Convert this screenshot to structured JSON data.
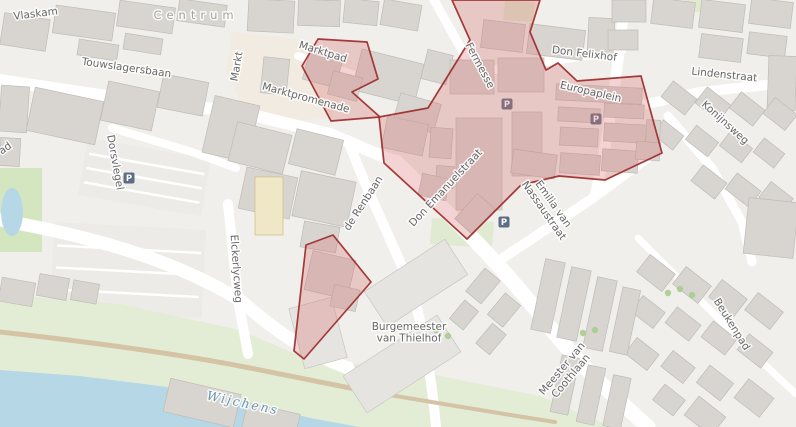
{
  "map": {
    "background": "#f0efeb",
    "palette": {
      "building_fill": "#d8d5d1",
      "building_stroke": "#bfbcb7",
      "building_light_fill": "#e6e4e0",
      "building_light_stroke": "#c9c6c1",
      "building_yellow_fill": "#f0e7c6",
      "building_yellow_stroke": "#cdbd85",
      "plaza": "#f2ebe1",
      "parking_lot": "#ecebe7",
      "green": "#dfead0",
      "green_band": "#e3edd6",
      "park": "#d4e6c0",
      "water": "#b6d7e6",
      "tan_path": "#d4c3a5",
      "road": "#ffffff",
      "overlay_fill": "#d97272",
      "overlay_fill_opacity": 0.31,
      "overlay_stroke": "#a03030",
      "overlay_stroke_width": 1.7,
      "label_color": "#676767",
      "place_label_color": "#a2a2a2",
      "water_label_color": "#6b95ab",
      "parking_icon_bg": "#5d6e84",
      "parking_icon_letter": "#ffffff",
      "tree": "#a8cc8f"
    },
    "highlight_polygons": [
      {
        "id": "marktpad-area",
        "points": "302,66 318,39 367,42 378,79 352,92 380,117 331,121"
      },
      {
        "id": "europaplein-shopping-area",
        "points": "452,0 540,0 530,32 546,70 558,63 577,81 641,76 662,153 605,180 559,176 521,185 467,239 384,163 379,117 428,108 470,40"
      },
      {
        "id": "renbaan-area",
        "points": "306,245 333,235 371,282 304,359 294,351"
      }
    ],
    "plazas": [
      {
        "points": "232,32 306,40 352,62 332,118 252,124 226,72"
      }
    ],
    "parking_lots": [
      {
        "x": 82,
        "y": 148,
        "w": 125,
        "h": 58,
        "rot": 10
      },
      {
        "x": 52,
        "y": 226,
        "w": 152,
        "h": 88,
        "rot": 3
      }
    ],
    "greens": [
      {
        "points": "0,294 120,304 240,330 300,356 310,427 0,427",
        "fill": "green_band"
      },
      {
        "points": "292,356 420,372 540,396 612,427 292,427",
        "fill": "green_band"
      },
      {
        "points": "0,168 42,168 42,252 0,252",
        "fill": "park"
      },
      {
        "points": "432,218 494,222 492,248 430,244",
        "fill": "green"
      },
      {
        "points": "505,0 535,2 533,22 503,20",
        "fill": "green"
      },
      {
        "points": "684,0 702,0 702,12 684,12",
        "fill": "green"
      }
    ],
    "water_polygons": [
      {
        "points": "0,370 80,376 160,386 240,400 310,418 360,427 0,427"
      }
    ],
    "pond": {
      "cx": 12,
      "cy": 212,
      "rx": 11,
      "ry": 24
    },
    "roads": [
      {
        "d": "M0,80 L120,98 L240,112",
        "w": 12
      },
      {
        "d": "M240,112 L330,134 L396,162",
        "w": 12
      },
      {
        "d": "M396,162 C450,215 500,262 548,325 C580,366 618,400 648,427",
        "w": 15
      },
      {
        "d": "M348,140 C370,200 395,245 415,300 C425,340 432,380 436,427",
        "w": 10
      },
      {
        "d": "M434,0 L472,68",
        "w": 9
      },
      {
        "d": "M478,72 L622,50",
        "w": 9
      },
      {
        "d": "M625,0 C618,60 612,120 596,192",
        "w": 11
      },
      {
        "d": "M612,112 L700,92 L796,82",
        "w": 10
      },
      {
        "d": "M668,116 L712,168 L742,222 L752,262",
        "w": 9
      },
      {
        "d": "M638,238 L700,300 L762,362 L796,394",
        "w": 7
      },
      {
        "d": "M228,204 L238,300 L248,354",
        "w": 10
      },
      {
        "d": "M0,220 C90,236 170,258 240,300 C272,328 304,352 348,368",
        "w": 13
      },
      {
        "d": "M298,56 L352,74 L382,90",
        "w": 8
      },
      {
        "d": "M112,128 L192,152 L236,168",
        "w": 8
      },
      {
        "d": "M658,150 L590,200 L497,262",
        "w": 10
      }
    ],
    "tan_paths": [
      {
        "d": "M0,332 C90,342 180,354 250,368 C300,378 330,384 360,390",
        "w": 5
      },
      {
        "d": "M360,390 C420,400 490,412 555,422",
        "w": 4
      }
    ],
    "buildings": [
      [
        2,
        16,
        46,
        32,
        9
      ],
      [
        54,
        9,
        60,
        28,
        8
      ],
      [
        118,
        4,
        56,
        26,
        8
      ],
      [
        178,
        2,
        48,
        22,
        8
      ],
      [
        78,
        42,
        40,
        16,
        9
      ],
      [
        124,
        36,
        38,
        16,
        9
      ],
      [
        0,
        86,
        28,
        46,
        4
      ],
      [
        0,
        138,
        20,
        28,
        3
      ],
      [
        30,
        94,
        70,
        44,
        12
      ],
      [
        104,
        86,
        52,
        40,
        12
      ],
      [
        160,
        78,
        46,
        34,
        11
      ],
      [
        208,
        100,
        46,
        58,
        13
      ],
      [
        248,
        0,
        46,
        32,
        3
      ],
      [
        298,
        0,
        42,
        26,
        2
      ],
      [
        344,
        0,
        34,
        24,
        6
      ],
      [
        382,
        2,
        38,
        26,
        10
      ],
      [
        262,
        58,
        26,
        36,
        6
      ],
      [
        356,
        56,
        64,
        42,
        14
      ],
      [
        396,
        98,
        42,
        30,
        16
      ],
      [
        424,
        52,
        26,
        30,
        14
      ],
      [
        232,
        128,
        56,
        40,
        14
      ],
      [
        292,
        134,
        48,
        36,
        14
      ],
      [
        242,
        172,
        52,
        42,
        12
      ],
      [
        296,
        176,
        56,
        46,
        12
      ],
      [
        302,
        224,
        36,
        26,
        10
      ],
      [
        482,
        22,
        42,
        28,
        7
      ],
      [
        528,
        27,
        56,
        30,
        7
      ],
      [
        588,
        18,
        26,
        38,
        3
      ],
      [
        612,
        0,
        34,
        22,
        0
      ],
      [
        652,
        0,
        42,
        26,
        7
      ],
      [
        700,
        2,
        44,
        28,
        7
      ],
      [
        750,
        0,
        42,
        26,
        7
      ],
      [
        700,
        36,
        42,
        24,
        7
      ],
      [
        748,
        34,
        38,
        22,
        7
      ],
      [
        608,
        30,
        30,
        20,
        0
      ],
      [
        768,
        56,
        28,
        54,
        2
      ],
      [
        664,
        88,
        30,
        20,
        38
      ],
      [
        698,
        94,
        30,
        20,
        38
      ],
      [
        732,
        99,
        30,
        20,
        38
      ],
      [
        766,
        104,
        28,
        20,
        38
      ],
      [
        655,
        126,
        26,
        18,
        38
      ],
      [
        688,
        132,
        28,
        18,
        38
      ],
      [
        722,
        138,
        28,
        18,
        38
      ],
      [
        756,
        144,
        26,
        18,
        38
      ],
      [
        694,
        172,
        30,
        20,
        38
      ],
      [
        728,
        180,
        30,
        20,
        38
      ],
      [
        762,
        188,
        28,
        20,
        38
      ],
      [
        746,
        200,
        50,
        56,
        6
      ],
      [
        640,
        262,
        32,
        22,
        38
      ],
      [
        676,
        274,
        32,
        22,
        38
      ],
      [
        712,
        287,
        32,
        22,
        38
      ],
      [
        748,
        300,
        32,
        22,
        38
      ],
      [
        634,
        302,
        28,
        20,
        38
      ],
      [
        668,
        314,
        30,
        20,
        38
      ],
      [
        704,
        328,
        30,
        20,
        38
      ],
      [
        740,
        341,
        30,
        20,
        38
      ],
      [
        628,
        344,
        28,
        20,
        38
      ],
      [
        664,
        357,
        28,
        20,
        38
      ],
      [
        700,
        372,
        30,
        22,
        38
      ],
      [
        738,
        386,
        32,
        24,
        38
      ],
      [
        688,
        404,
        34,
        24,
        38
      ],
      [
        656,
        390,
        26,
        20,
        38
      ],
      [
        468,
        276,
        30,
        20,
        -50
      ],
      [
        490,
        300,
        28,
        20,
        -50
      ],
      [
        452,
        306,
        24,
        18,
        -50
      ],
      [
        478,
        330,
        26,
        18,
        -50
      ],
      [
        538,
        260,
        20,
        72,
        12
      ],
      [
        564,
        268,
        20,
        72,
        12
      ],
      [
        590,
        278,
        20,
        72,
        12
      ],
      [
        616,
        288,
        18,
        66,
        12
      ],
      [
        556,
        356,
        18,
        58,
        12
      ],
      [
        582,
        366,
        18,
        58,
        12
      ],
      [
        608,
        376,
        18,
        52,
        12
      ],
      [
        368,
        262,
        96,
        42,
        -33,
        "l"
      ],
      [
        346,
        342,
        112,
        44,
        -33,
        "l"
      ],
      [
        296,
        302,
        44,
        62,
        -15,
        "l"
      ],
      [
        166,
        386,
        72,
        34,
        13
      ],
      [
        244,
        408,
        54,
        26,
        13
      ],
      [
        0,
        280,
        34,
        24,
        10
      ],
      [
        38,
        276,
        30,
        22,
        10
      ],
      [
        72,
        282,
        26,
        20,
        10
      ],
      [
        255,
        177,
        28,
        58,
        0,
        "y"
      ],
      [
        450,
        60,
        44,
        34,
        0
      ],
      [
        498,
        58,
        46,
        34,
        0
      ],
      [
        456,
        118,
        46,
        92,
        0
      ],
      [
        512,
        112,
        30,
        64,
        0
      ],
      [
        430,
        128,
        22,
        30,
        4
      ],
      [
        436,
        166,
        18,
        22,
        4
      ],
      [
        384,
        120,
        42,
        32,
        12
      ],
      [
        420,
        176,
        28,
        22,
        12
      ],
      [
        458,
        202,
        34,
        24,
        -48
      ],
      [
        556,
        86,
        86,
        16,
        3
      ],
      [
        558,
        108,
        42,
        14,
        3
      ],
      [
        604,
        104,
        40,
        14,
        3
      ],
      [
        560,
        128,
        38,
        18,
        3
      ],
      [
        604,
        124,
        42,
        18,
        3
      ],
      [
        646,
        120,
        14,
        26,
        3
      ],
      [
        512,
        152,
        44,
        24,
        8
      ],
      [
        560,
        154,
        40,
        20,
        4
      ],
      [
        602,
        150,
        36,
        22,
        4
      ],
      [
        636,
        142,
        24,
        18,
        4
      ],
      [
        306,
        52,
        34,
        32,
        15
      ],
      [
        330,
        74,
        30,
        24,
        15
      ],
      [
        308,
        255,
        44,
        40,
        13
      ],
      [
        332,
        287,
        26,
        22,
        13
      ]
    ],
    "trees": [
      [
        668,
        293
      ],
      [
        680,
        289
      ],
      [
        692,
        295
      ],
      [
        583,
        333
      ],
      [
        595,
        330
      ],
      [
        448,
        336
      ],
      [
        436,
        330
      ]
    ],
    "parking_icons": [
      {
        "x": 129,
        "y": 178
      },
      {
        "x": 507,
        "y": 104
      },
      {
        "x": 596,
        "y": 119
      },
      {
        "x": 504,
        "y": 222
      }
    ],
    "labels": [
      {
        "t": "Vlaskam",
        "x": 36,
        "y": 17,
        "r": -7
      },
      {
        "t": "Centrum",
        "x": 196,
        "y": 19,
        "r": 0,
        "kind": "place"
      },
      {
        "t": "Touwslagersbaan",
        "x": 126,
        "y": 71,
        "r": 8
      },
      {
        "t": "Markt",
        "x": 240,
        "y": 67,
        "r": -80
      },
      {
        "t": "Marktpad",
        "x": 322,
        "y": 55,
        "r": 17
      },
      {
        "t": "Marktpromenade",
        "x": 305,
        "y": 101,
        "r": 15
      },
      {
        "t": "Dorsvlegel",
        "x": 112,
        "y": 163,
        "r": 80
      },
      {
        "t": "Fermesse",
        "x": 477,
        "y": 67,
        "r": 62
      },
      {
        "t": "Don Felixhof",
        "x": 584,
        "y": 57,
        "r": 7
      },
      {
        "t": "Lindenstraat",
        "x": 724,
        "y": 78,
        "r": 6
      },
      {
        "t": "Konijnsweg",
        "x": 723,
        "y": 125,
        "r": 42
      },
      {
        "t": "Europaplein",
        "x": 590,
        "y": 95,
        "r": 13
      },
      {
        "t": "Don Emanuelstraat",
        "x": 448,
        "y": 190,
        "r": -47
      },
      {
        "t": "de Renbaan",
        "x": 366,
        "y": 205,
        "r": -57
      },
      {
        "t": "Elckerlycweg",
        "x": 233,
        "y": 269,
        "r": 86
      },
      {
        "lines": [
          "Emilia van",
          "Nassaustraat"
        ],
        "x": 549,
        "y": 207,
        "r": 55
      },
      {
        "lines": [
          "Burgemeester",
          "van Thielhof"
        ],
        "x": 409,
        "y": 332,
        "r": 0
      },
      {
        "lines": [
          "Meester van",
          "Coothlaan"
        ],
        "x": 566,
        "y": 372,
        "r": -50
      },
      {
        "t": "Beukenpad",
        "x": 729,
        "y": 326,
        "r": 58
      },
      {
        "t": "Wijchens",
        "x": 242,
        "y": 407,
        "r": 12,
        "kind": "water"
      },
      {
        "t": "ad",
        "x": 7,
        "y": 151,
        "r": -35
      }
    ]
  }
}
